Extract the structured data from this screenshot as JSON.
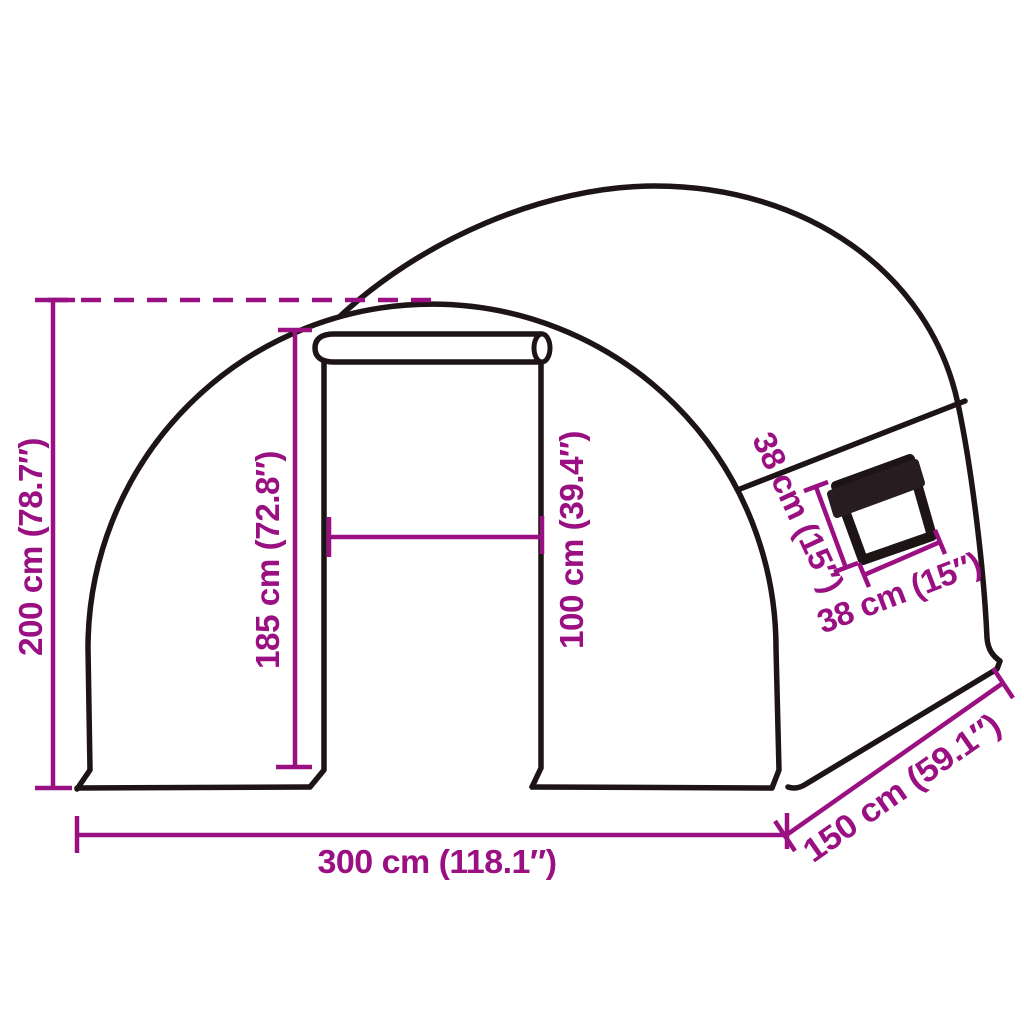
{
  "diagram": {
    "subject": "tunnel-greenhouse-dimension-diagram",
    "labels": {
      "total_height": "200 cm (78.7″)",
      "door_height": "185 cm (72.8″)",
      "door_width": "100 cm (39.4″)",
      "window_height": "38 cm (15″)",
      "window_width": "38 cm (15″)",
      "total_width": "300 cm (118.1″)",
      "total_depth": "150 cm (59.1″)"
    },
    "colors": {
      "outline": "#1d1416",
      "dimension": "#9a1082",
      "shade": "#271c1f",
      "background": "#ffffff"
    }
  }
}
